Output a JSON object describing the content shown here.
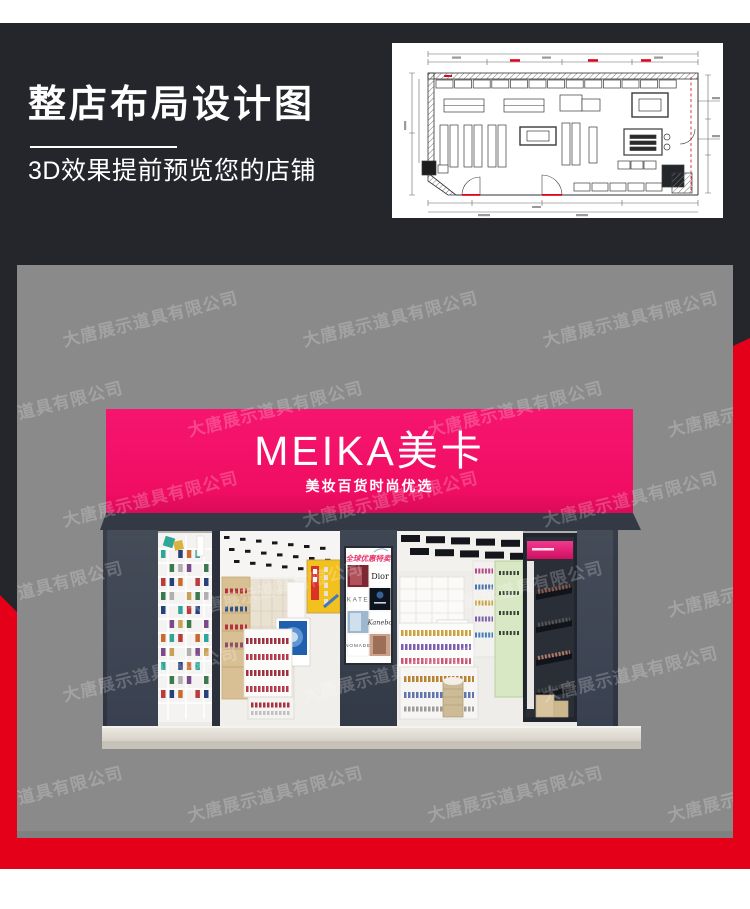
{
  "banner": {
    "heading": "整店布局设计图",
    "subheading": "3D效果提前预览您的店铺"
  },
  "storefront": {
    "sign_title": "MEIKA美卡",
    "sign_subtitle": "美妆百货时尚优选",
    "poster": {
      "header": "全球优惠特卖",
      "brands": [
        "Dior",
        "KATE",
        "Kanebo",
        "NOMADE"
      ]
    }
  },
  "watermark": {
    "text": "大唐展示道具有限公司"
  },
  "colors": {
    "accent_red": "#e50019",
    "sign_magenta": "#f00d63",
    "panel_dark": "#24262c",
    "background_gray": "#8a8a8a",
    "canopy_dark": "#333a45",
    "footer_white": "#ffffff"
  }
}
